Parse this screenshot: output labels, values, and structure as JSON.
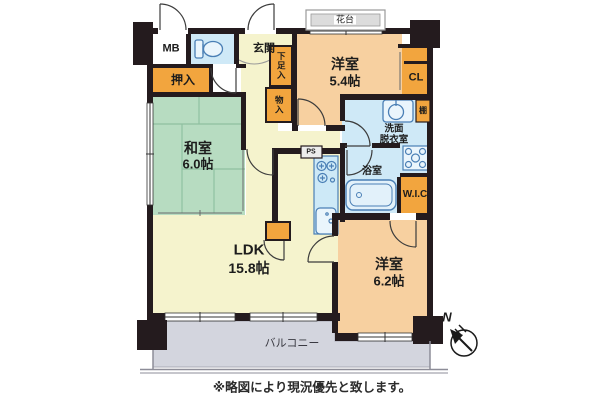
{
  "note": "※略図により現況優先と致します。",
  "rooms": {
    "washitsu": {
      "name": "和室",
      "size": "6.0帖"
    },
    "ldk": {
      "name": "LDK",
      "size": "15.8帖"
    },
    "bedroom1": {
      "name": "洋室",
      "size": "5.4帖"
    },
    "bedroom2": {
      "name": "洋室",
      "size": "6.2帖"
    },
    "genkan": {
      "name": "玄関"
    },
    "senmen": {
      "line1": "洗面",
      "line2": "脱衣室"
    },
    "bath": {
      "name": "浴室"
    },
    "balcony": {
      "name": "バルコニー"
    }
  },
  "storage": {
    "oshiire": "押入",
    "getabako": "下足入",
    "monoire": "物入",
    "closet": "CL",
    "wic": "W.I.C",
    "shelf": "棚",
    "meter_box": "MB",
    "pipe_space": "PS",
    "flower_stand": "花台"
  },
  "compass": {
    "label": "N"
  },
  "colors": {
    "wall": "#241b1e",
    "room_yellow": "#f5f3cd",
    "room_green": "#b7dcc1",
    "room_peach": "#f7d0a0",
    "room_blue": "#cfe9f7",
    "storage_orange": "#f2a53e",
    "balcony_gray": "#d3d5de",
    "fixture_stroke": "#4a7fb5"
  }
}
